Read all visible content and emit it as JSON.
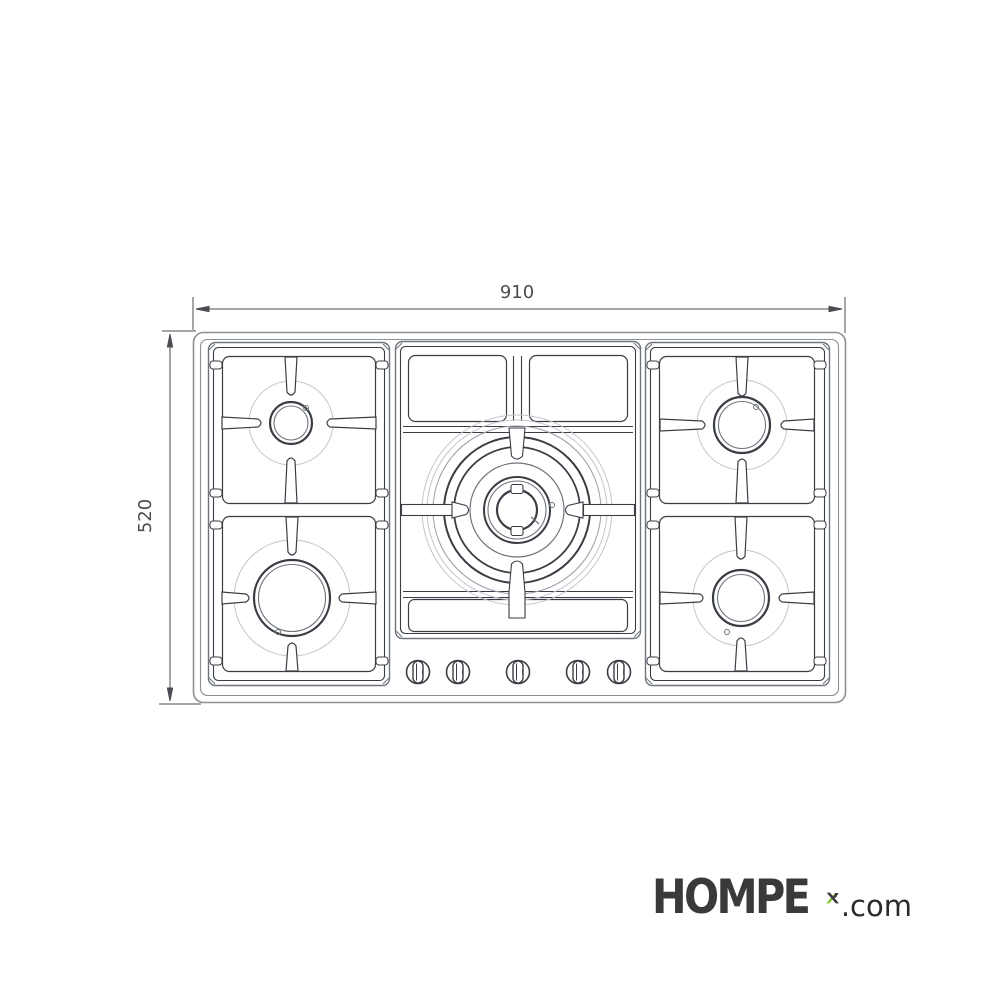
{
  "drawing": {
    "type": "gas-hob-top-view-technical-drawing",
    "width_label": "910",
    "height_label": "520",
    "burner_count": 5,
    "knob_count": 5,
    "colors": {
      "line_dark": "#3a3e44",
      "line_medium": "#6e747c",
      "line_light": "#c2c6cc",
      "body_outline": "#8b9097",
      "dimension": "#4a4d52"
    }
  },
  "logo": {
    "brand": "HOMPE",
    "brand_x_letter": "X",
    "suffix": ".com",
    "brand_color": "#3a3a3c",
    "accent_green": "#8cc63e",
    "suffix_color": "#2b2b2d"
  }
}
